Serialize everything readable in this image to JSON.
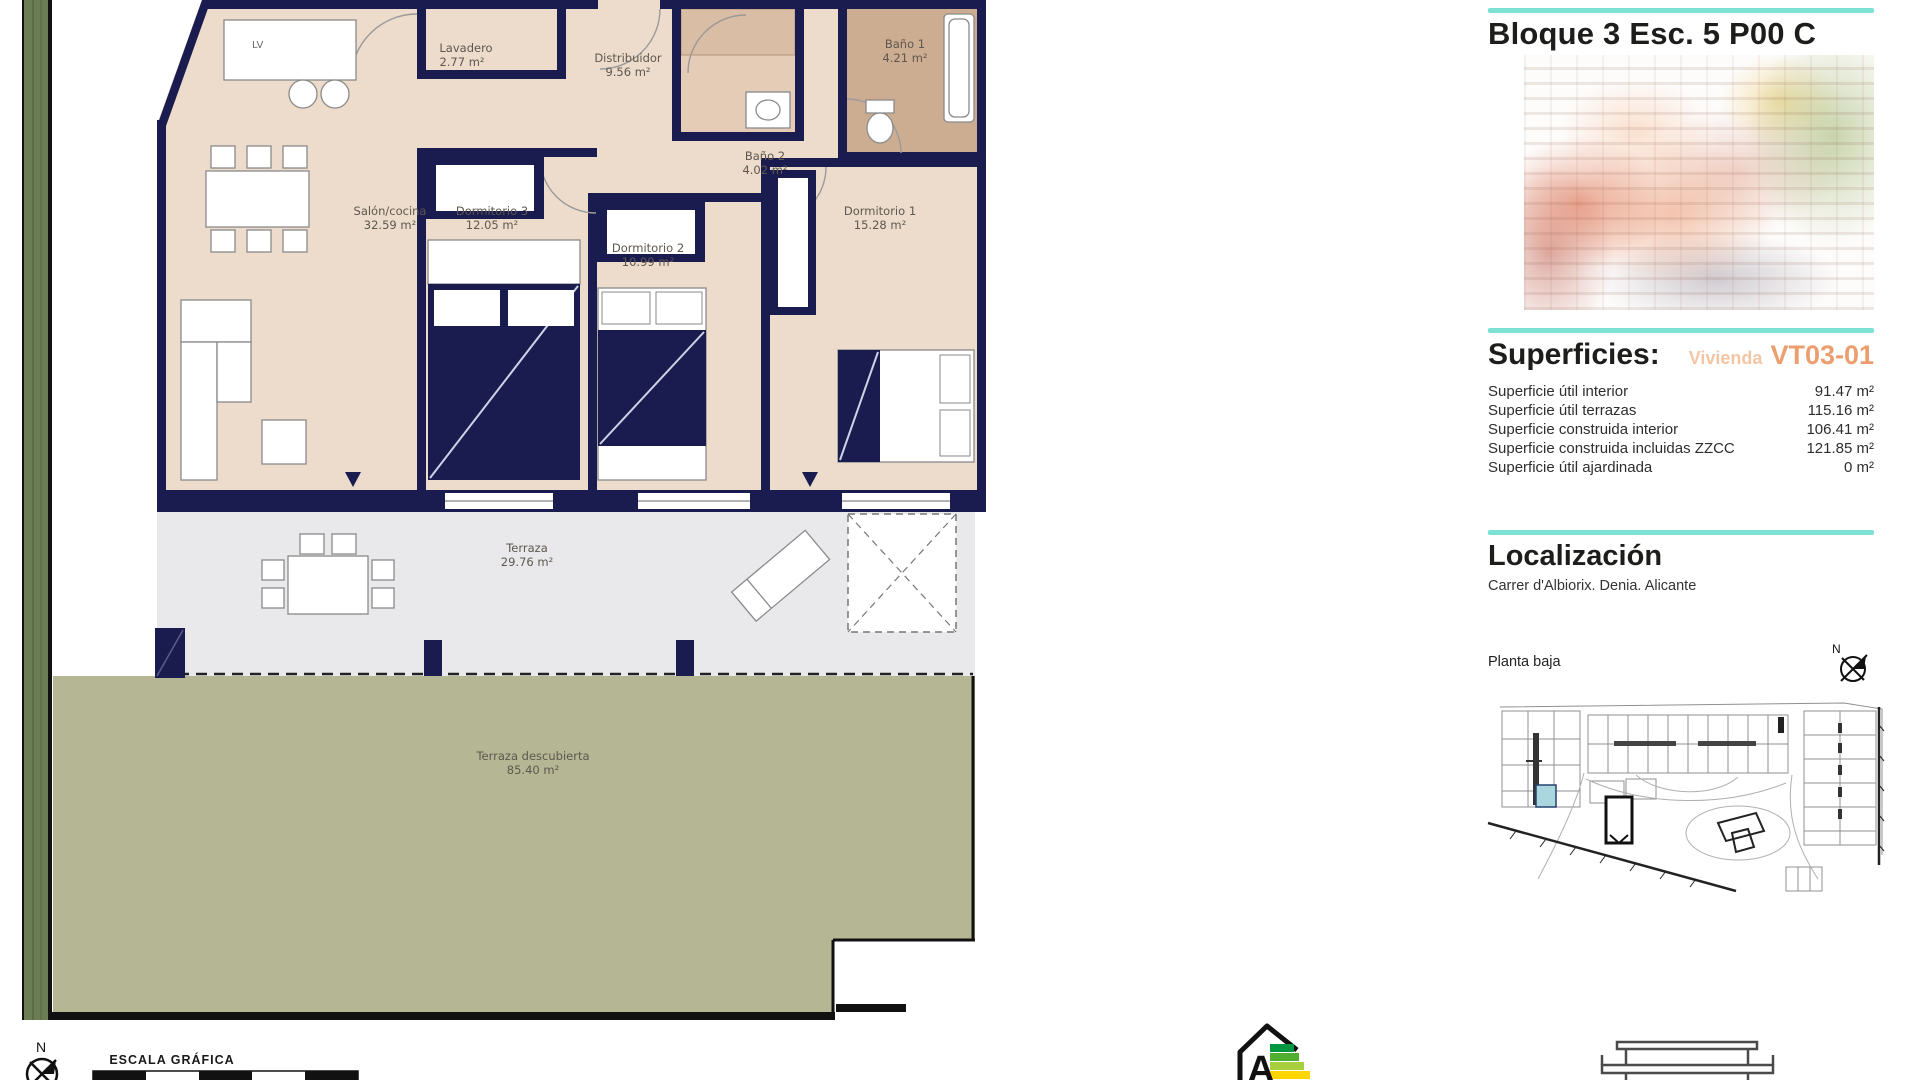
{
  "panel": {
    "title": "Bloque 3 Esc. 5 P00 C",
    "superficies": {
      "heading": "Superficies:",
      "vivienda_label": "Vivienda",
      "vivienda_code": "VT03-01",
      "rows": [
        {
          "label": "Superficie útil interior",
          "value": "91.47 m²"
        },
        {
          "label": "Superficie útil terrazas",
          "value": "115.16 m²"
        },
        {
          "label": "Superficie construida interior",
          "value": "106.41 m²"
        },
        {
          "label": "Superficie construida incluidas ZZCC",
          "value": "121.85 m²"
        },
        {
          "label": "Superficie útil ajardinada",
          "value": "0 m²"
        }
      ]
    },
    "localizacion": {
      "heading": "Localización",
      "address": "Carrer d'Albiorix. Denia. Alicante",
      "floor_label": "Planta baja",
      "compass_label": "N"
    }
  },
  "floorplan": {
    "kitchen_island_label": "LV",
    "compass_label": "N",
    "scale_label": "ESCALA GRÁFICA",
    "rooms": [
      {
        "name": "Salón/cocina",
        "area": "32.59 m²"
      },
      {
        "name": "Lavadero",
        "area": "2.77 m²"
      },
      {
        "name": "Distribuidor",
        "area": "9.56 m²"
      },
      {
        "name": "Baño 2",
        "area": "4.02 m²"
      },
      {
        "name": "Baño 1",
        "area": "4.21 m²"
      },
      {
        "name": "Dormitorio 3",
        "area": "12.05 m²"
      },
      {
        "name": "Dormitorio 2",
        "area": "10.99 m²"
      },
      {
        "name": "Dormitorio 1",
        "area": "15.28 m²"
      },
      {
        "name": "Terraza",
        "area": "29.76 m²"
      },
      {
        "name": "Terraza descubierta",
        "area": "85.40 m²"
      }
    ]
  },
  "energy_label": {
    "letter": "A"
  },
  "colors": {
    "accent_teal": "#7DE2D3",
    "accent_orange": "#EC9F6E",
    "accent_orange_light": "#F2C6A4",
    "wall_navy": "#1A1C4F",
    "interior_beige": "#EDDCCB",
    "bath_tan": "#CDAD92",
    "terrace_gray": "#E9E9EB",
    "garden_green": "#B5B794",
    "hedge_green": "#6B7D55",
    "site_highlight": "#A9D7DD"
  }
}
